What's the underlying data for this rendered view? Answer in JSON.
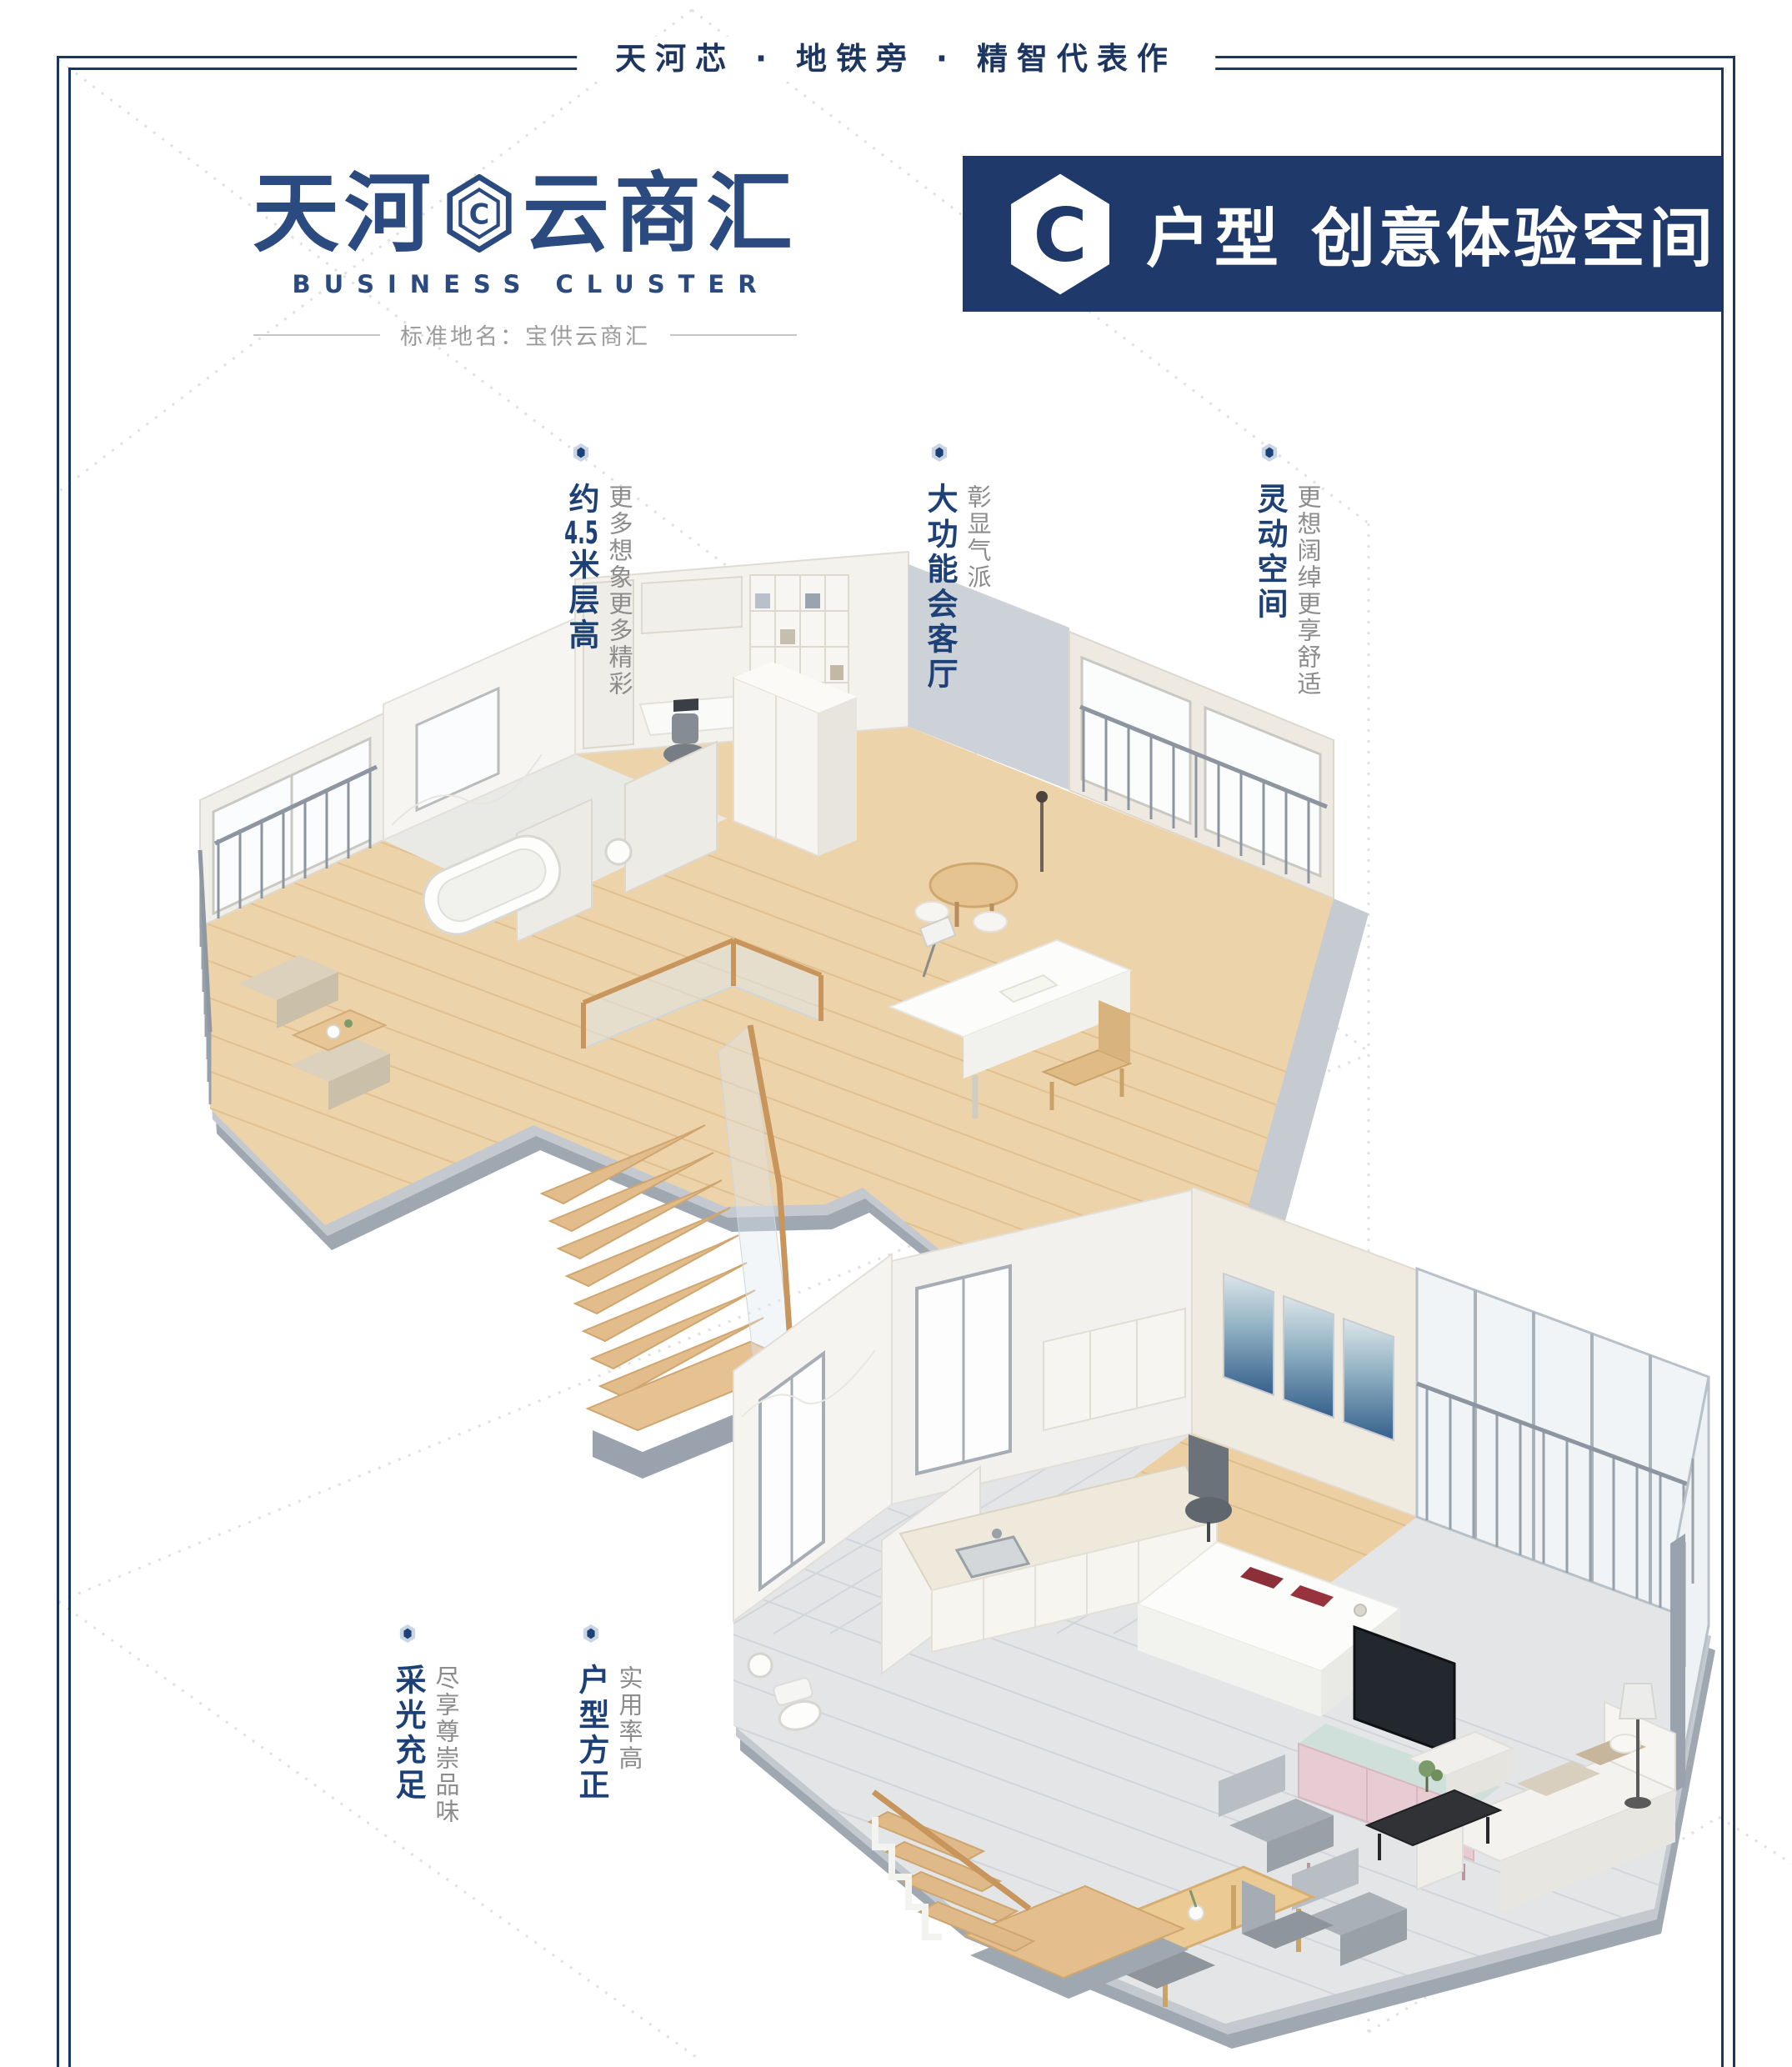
{
  "tagline": "天河芯 · 地铁旁 · 精智代表作",
  "logo": {
    "name_left": "天河",
    "name_right": "云商汇",
    "hex_letter": "C",
    "hex_icon": "hexagon-c-icon",
    "subtitle": "BUSINESS CLUSTER",
    "standard_name": "标准地名：宝供云商汇"
  },
  "banner": {
    "hex_letter": "C",
    "unit_label": "户型",
    "title": "创意体验空间",
    "bg_color": "#20396b"
  },
  "features_top": [
    {
      "title": "约4.5米层高",
      "subtitle": "更多想象更多精彩"
    },
    {
      "title": "大功能会客厅",
      "subtitle": "彰显气派"
    },
    {
      "title": "灵动空间",
      "subtitle": "更想阔绰更享舒适"
    }
  ],
  "features_bottom": [
    {
      "title": "采光充足",
      "subtitle": "尽享尊崇品味"
    },
    {
      "title": "户型方正",
      "subtitle": "实用率高"
    }
  ],
  "icons": {
    "feature_bullet": "hexagon-dot-icon",
    "logo_mark": "hexagon-c-icon"
  },
  "colors": {
    "navy": "#2a4a80",
    "deep_navy": "#1d3660",
    "banner_bg": "#20396b",
    "feature_blue": "#1d4076",
    "gray_text": "#8c8c8c",
    "divider_gray": "#c6c6c6",
    "wood_floor": "#edd3a9",
    "slab_gray": "#9fa8b1",
    "tile_gray": "#e3e5e7"
  },
  "renders": {
    "upper_unit": "loft-level-3d-floorplan",
    "lower_unit": "ground-level-3d-floorplan"
  }
}
